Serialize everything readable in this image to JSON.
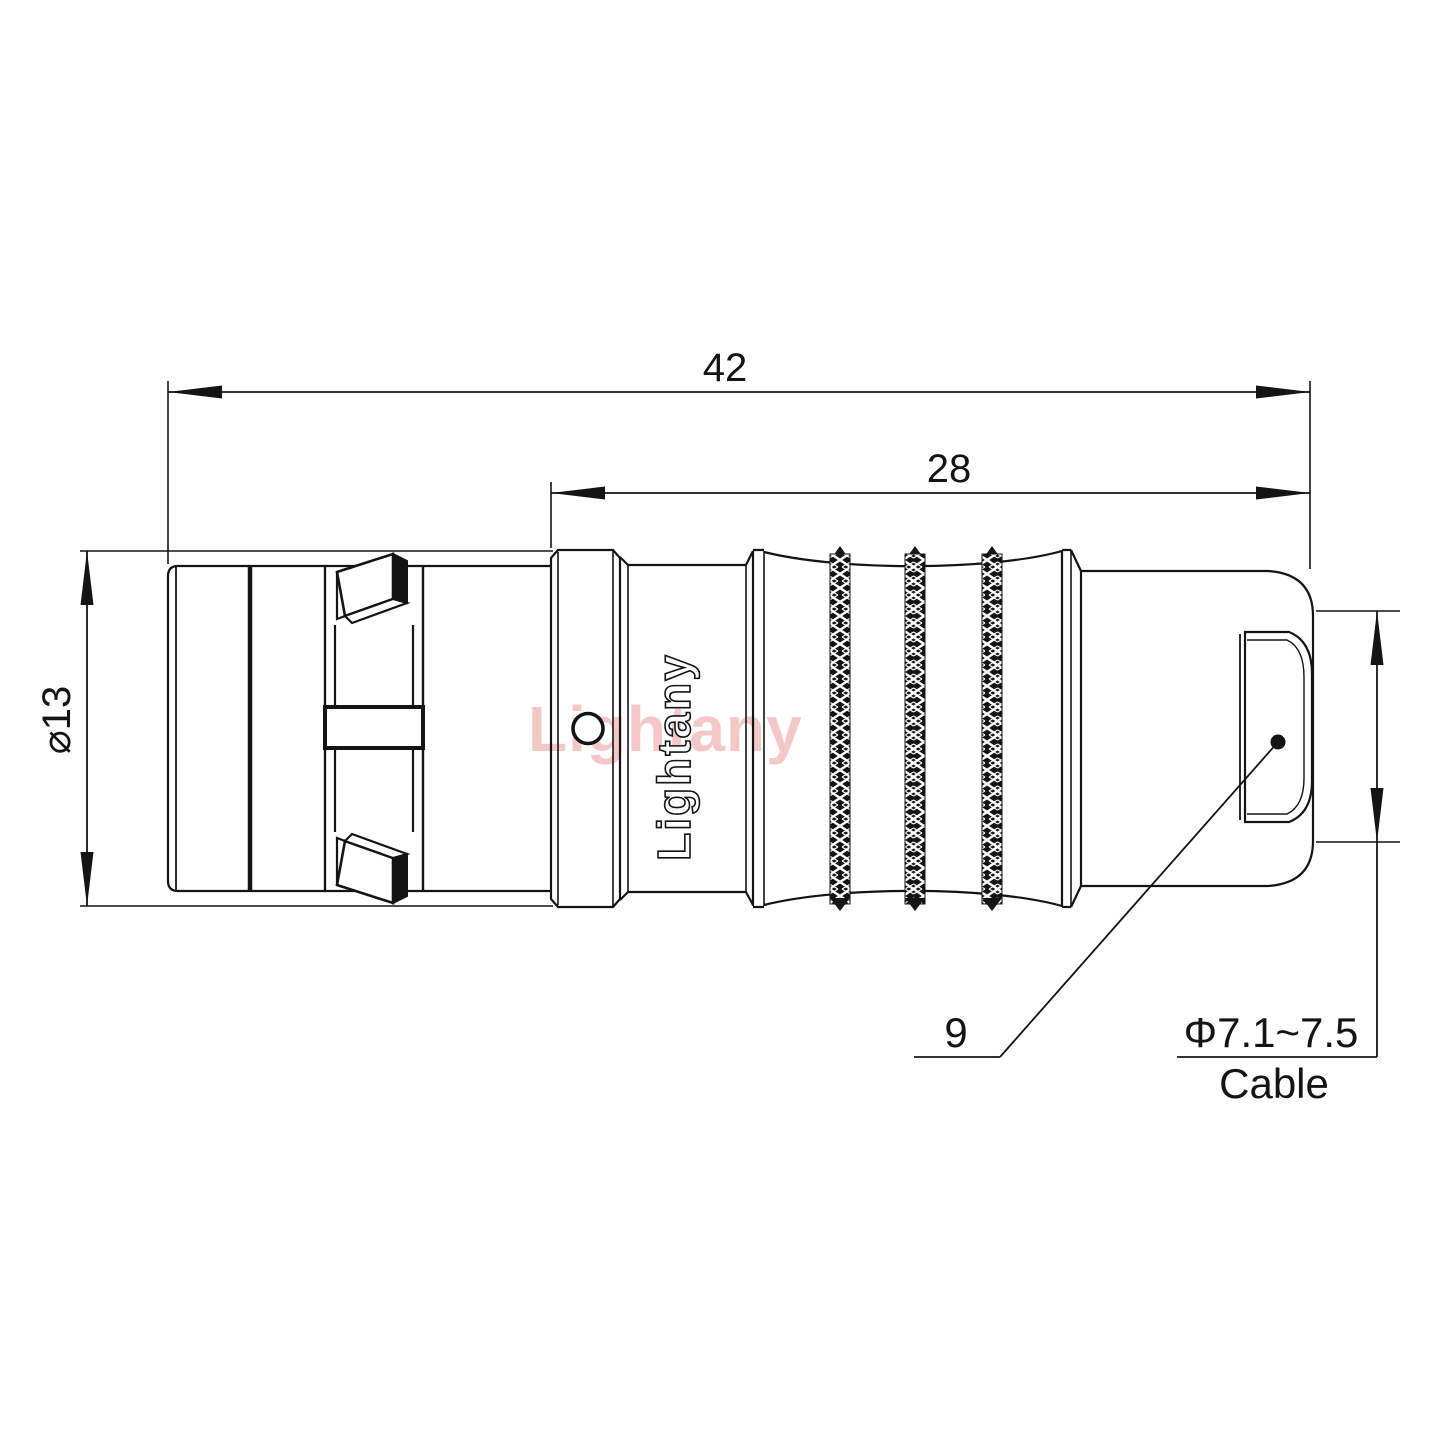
{
  "drawing": {
    "background": "#ffffff",
    "line_color": "#141414",
    "dimensions": {
      "overall_length": "42",
      "rear_section_length": "28",
      "body_diameter": "⌀13",
      "cable_entry_ref": "9",
      "cable_diameter": "Φ7.1~7.5",
      "cable_label": "Cable"
    },
    "branding": {
      "engraved_text": "Lightany",
      "watermark_text": "Lightany",
      "watermark_color": "#f5c8c8"
    }
  }
}
